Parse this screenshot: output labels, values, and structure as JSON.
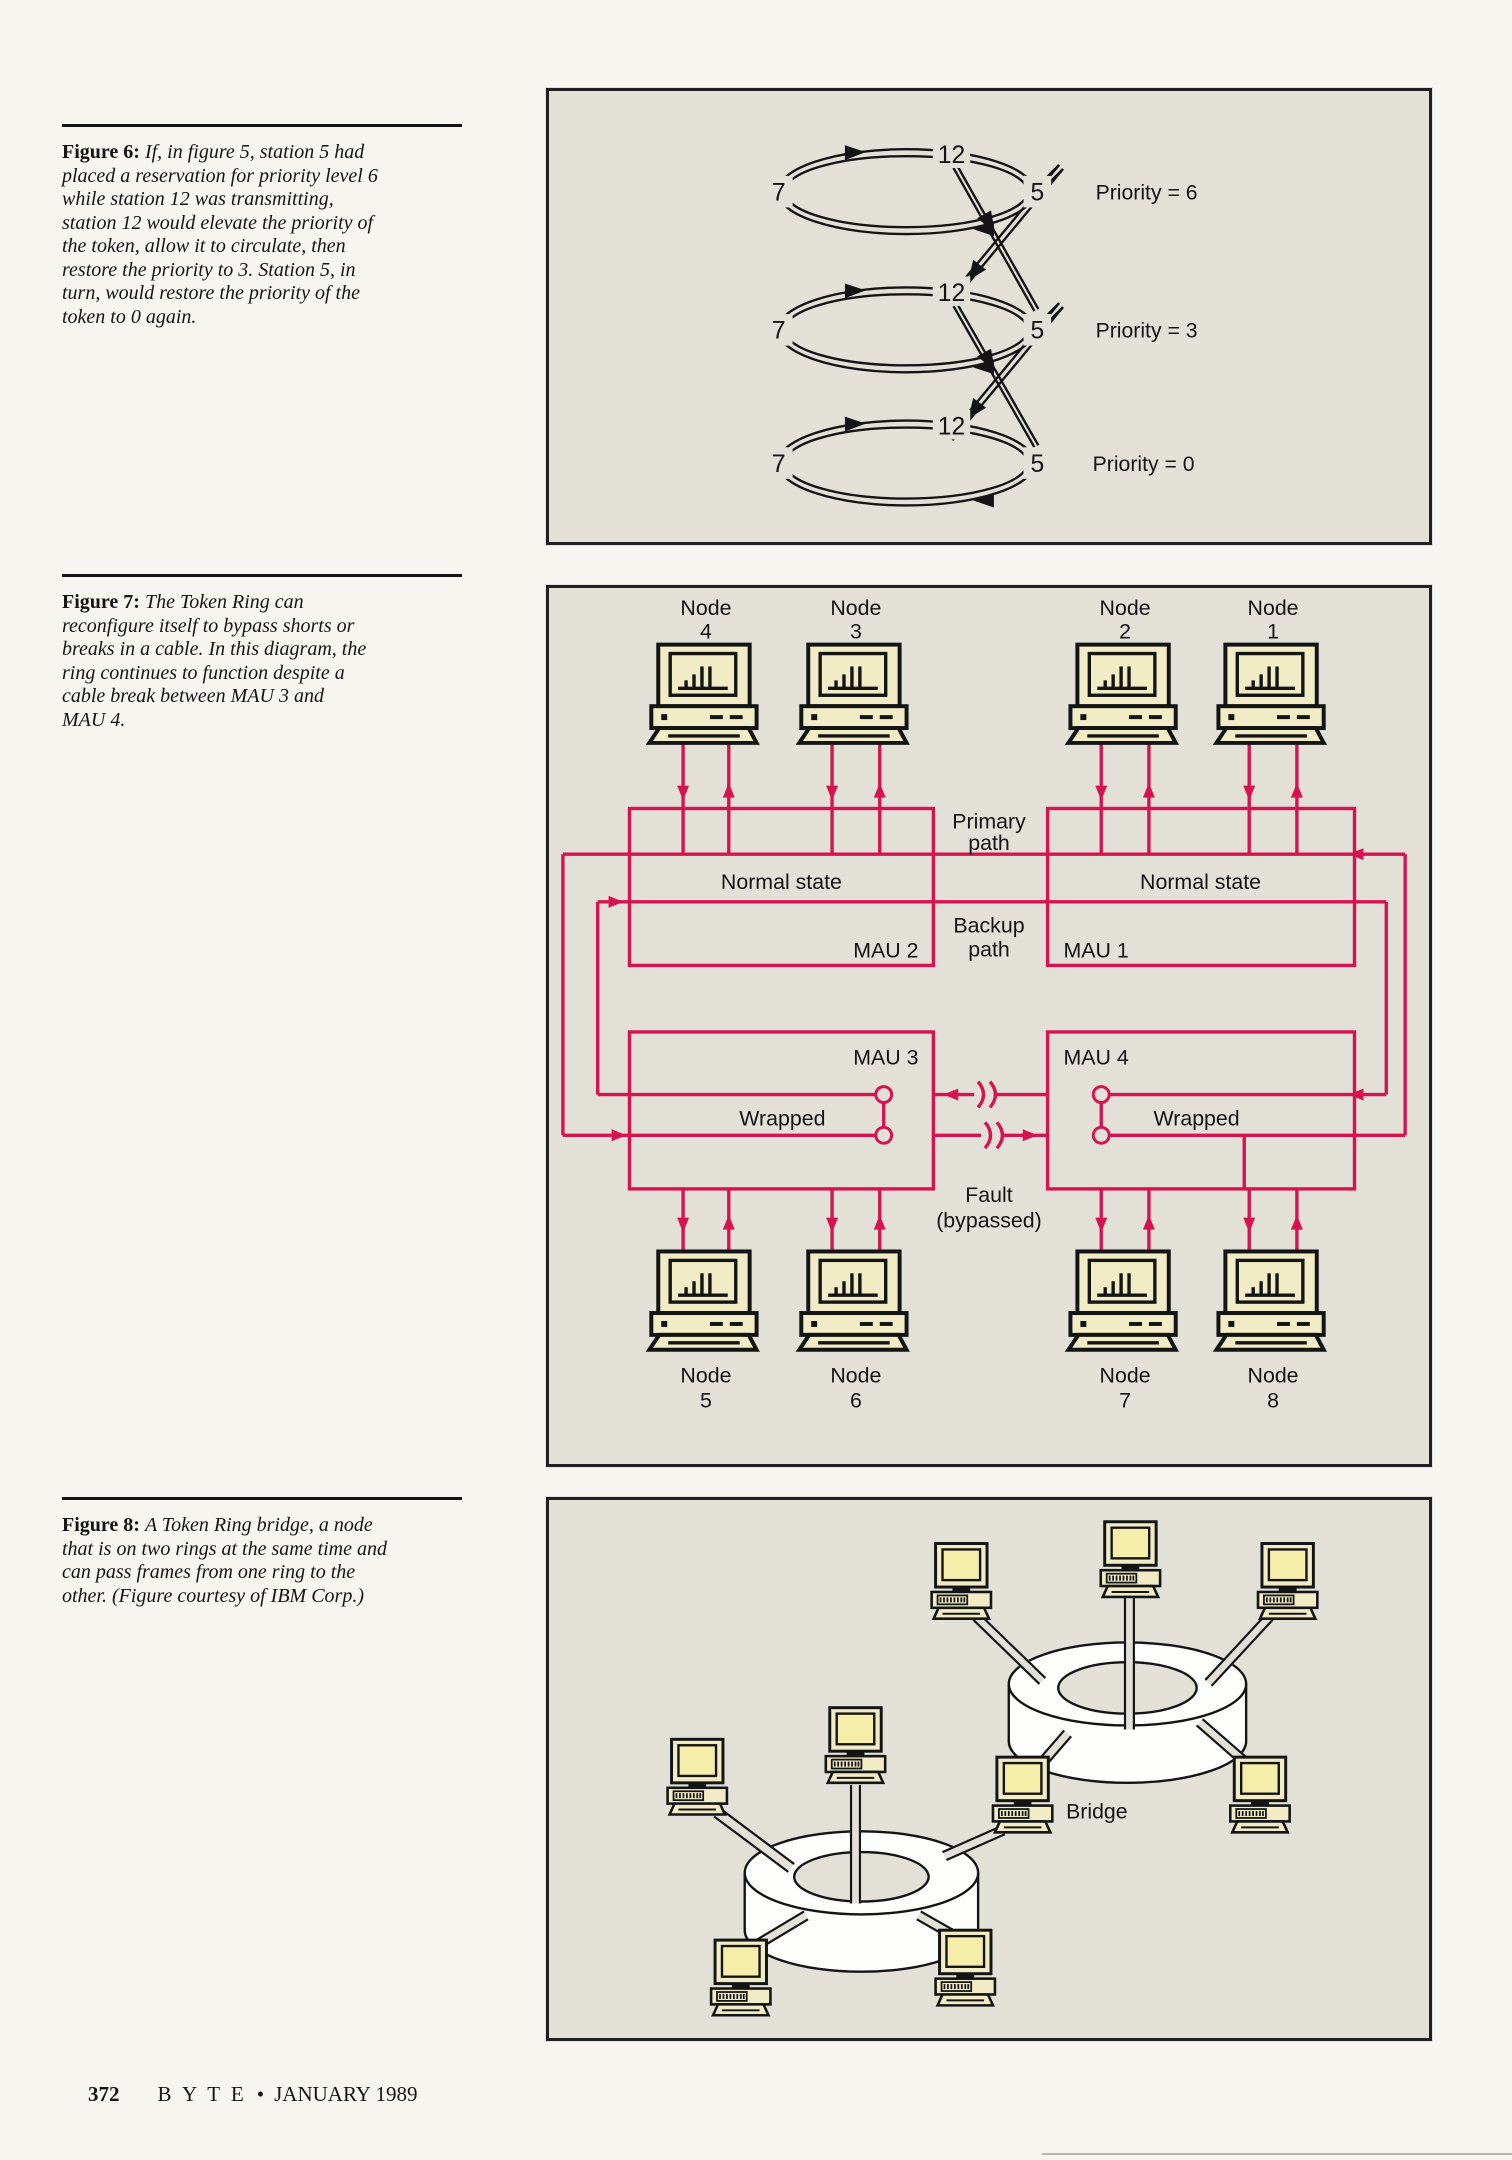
{
  "colors": {
    "page_bg": "#f7f5f0",
    "panel_bg": "#e2e0d7",
    "diagram_red": "#d6134f",
    "computer_cream": "#f2ecc6",
    "screen_yellow": "#f5eeab",
    "ink": "#1c1c1c"
  },
  "figure6": {
    "caption_label": "Figure 6:",
    "caption_text": "If, in figure 5, station 5 had\nplaced a reservation for priority level 6\nwhile station 12 was transmitting,\nstation 12 would elevate the priority of\nthe token, allow it to circulate, then\nrestore the priority to 3. Station 5, in\nturn, would restore the priority of the\ntoken to 0 again.",
    "stations": {
      "left": "7",
      "top": "12",
      "right": "5"
    },
    "priority_labels": [
      "Priority = 6",
      "Priority = 3",
      "Priority = 0"
    ]
  },
  "figure7": {
    "caption_label": "Figure 7:",
    "caption_text": "The Token Ring can\nreconfigure itself to bypass shorts or\nbreaks in a cable. In this diagram, the\nring continues to function despite a\ncable break between MAU 3 and\nMAU 4.",
    "node_word": "Node",
    "top_node_numbers": [
      "4",
      "3",
      "2",
      "1"
    ],
    "bottom_node_numbers": [
      "5",
      "6",
      "7",
      "8"
    ],
    "mau1": "MAU 1",
    "mau2": "MAU 2",
    "mau3": "MAU 3",
    "mau4": "MAU 4",
    "normal_state": "Normal state",
    "wrapped": "Wrapped",
    "primary_path_line1": "Primary",
    "primary_path_line2": "path",
    "backup_path_line1": "Backup",
    "backup_path_line2": "path",
    "fault_line1": "Fault",
    "fault_line2": "(bypassed)"
  },
  "figure8": {
    "caption_label": "Figure 8:",
    "caption_text": "A Token Ring bridge, a node\nthat is on two rings at the same time and\ncan pass frames from one ring to the\nother. (Figure courtesy of IBM Corp.)",
    "bridge_label": "Bridge"
  },
  "footer": {
    "page_number": "372",
    "magazine": "B Y T E",
    "separator": "•",
    "date": "JANUARY 1989"
  }
}
